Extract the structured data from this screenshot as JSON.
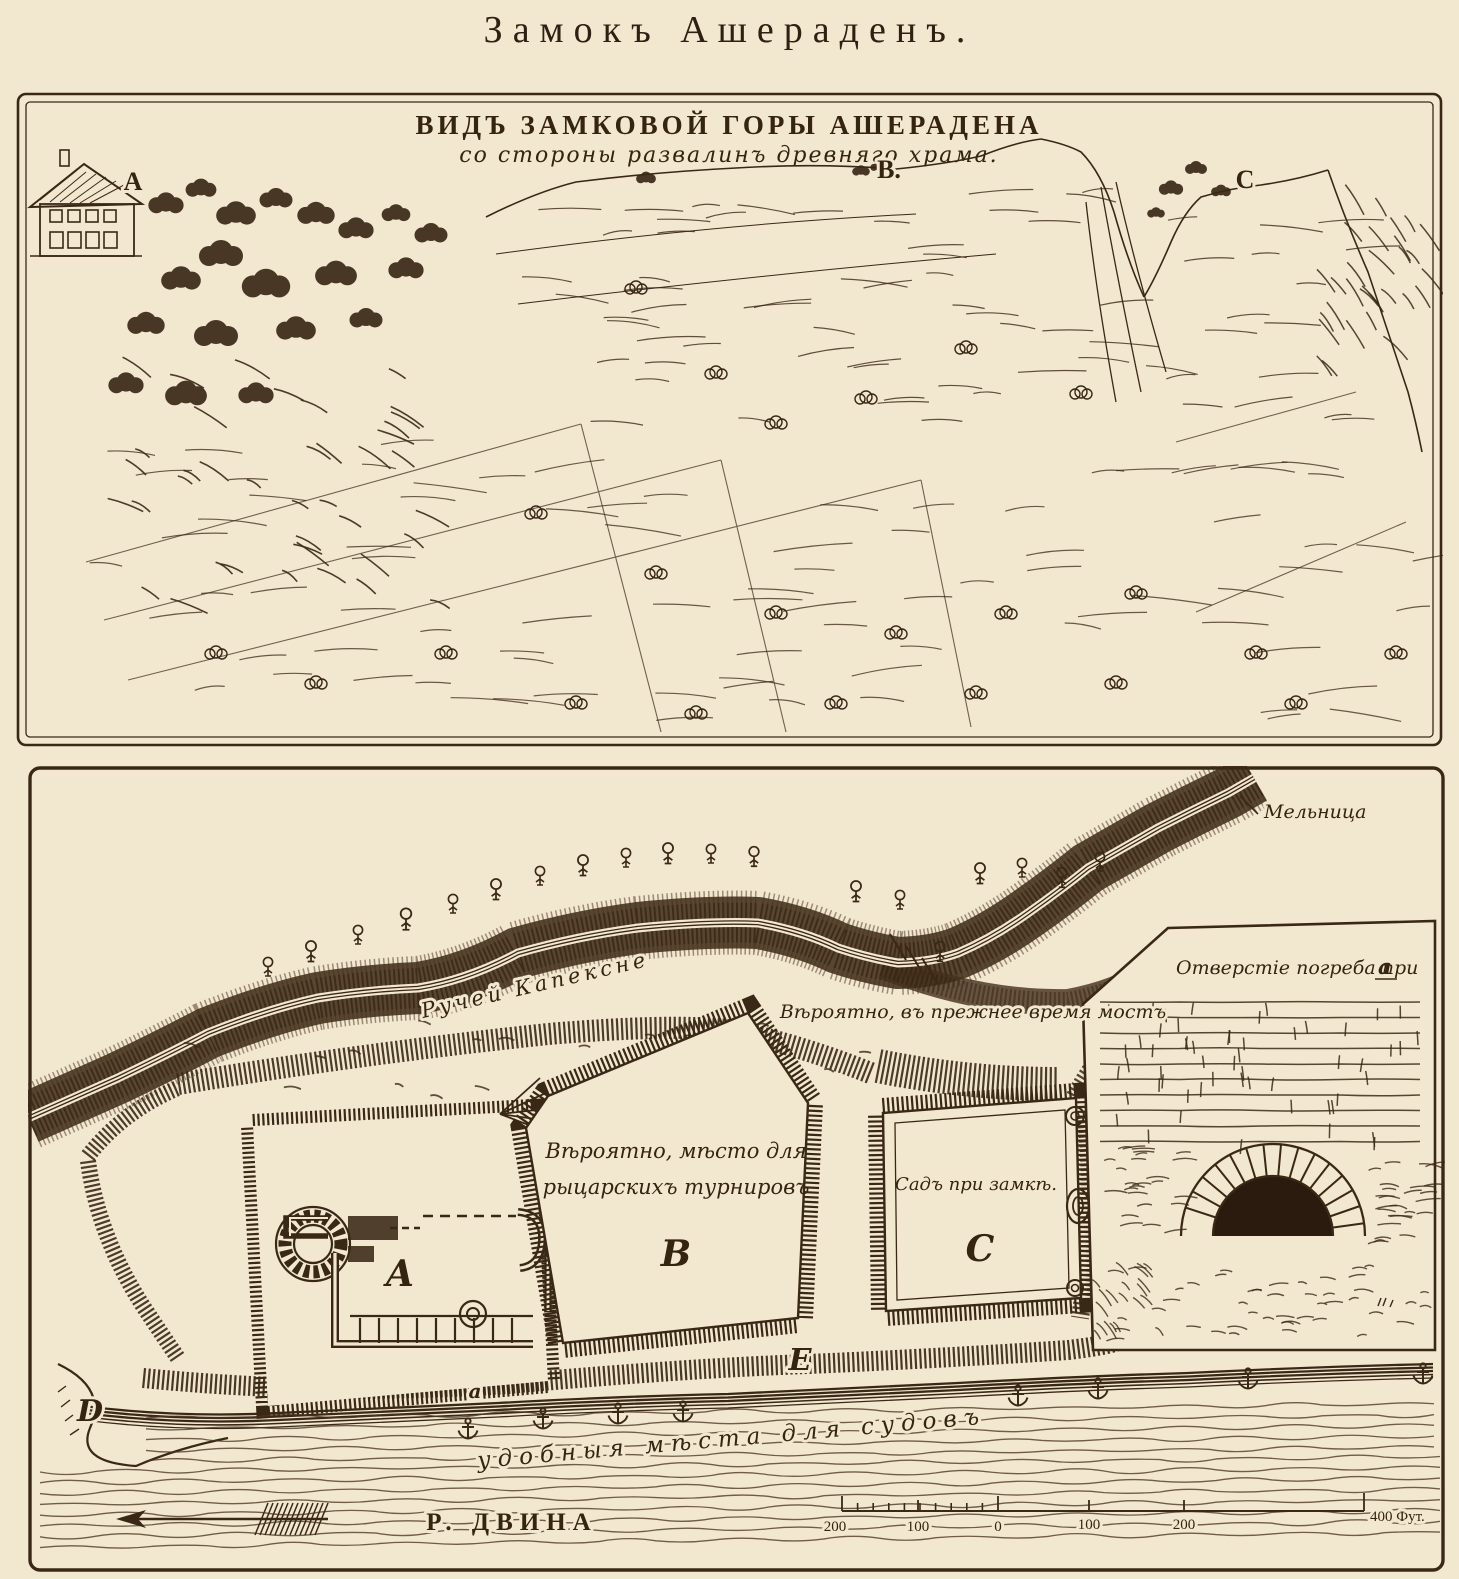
{
  "page": {
    "title": "Замокъ Ашераденъ.",
    "colors": {
      "ink": "#3a2817",
      "paper": "#f2e7cf",
      "water_line": "#4b3520"
    }
  },
  "view_panel": {
    "title": "ВИДЪ ЗАМКОВОЙ ГОРЫ АШЕРАДЕНА",
    "subtitle": "со стороны развалинъ древняго храма.",
    "marker_a": "A",
    "marker_b": "B.",
    "marker_c": "C"
  },
  "plan_panel": {
    "mill": "Мельница",
    "stream": "Ручей Капексне",
    "bridge": "Вѣроятно, въ прежнее время мостъ",
    "inset_title": "Отверстіе погреба при",
    "inset_title_ref": "a",
    "tournament_line1": "Вѣроятно, мѣсто для",
    "tournament_line2": "рыцарскихъ турнировъ",
    "garden": "Садъ при замкѣ.",
    "anchorage": "удобныя мѣста для судовъ",
    "river": "Р. ДВИНА",
    "marker_castle": "A",
    "marker_tournament": "B",
    "marker_garden": "C",
    "marker_d": "D",
    "marker_e": "E",
    "marker_cellar": "a",
    "scale": {
      "labels": [
        "200",
        "100",
        "0",
        "100",
        "200"
      ],
      "end": "400 Фут."
    }
  }
}
